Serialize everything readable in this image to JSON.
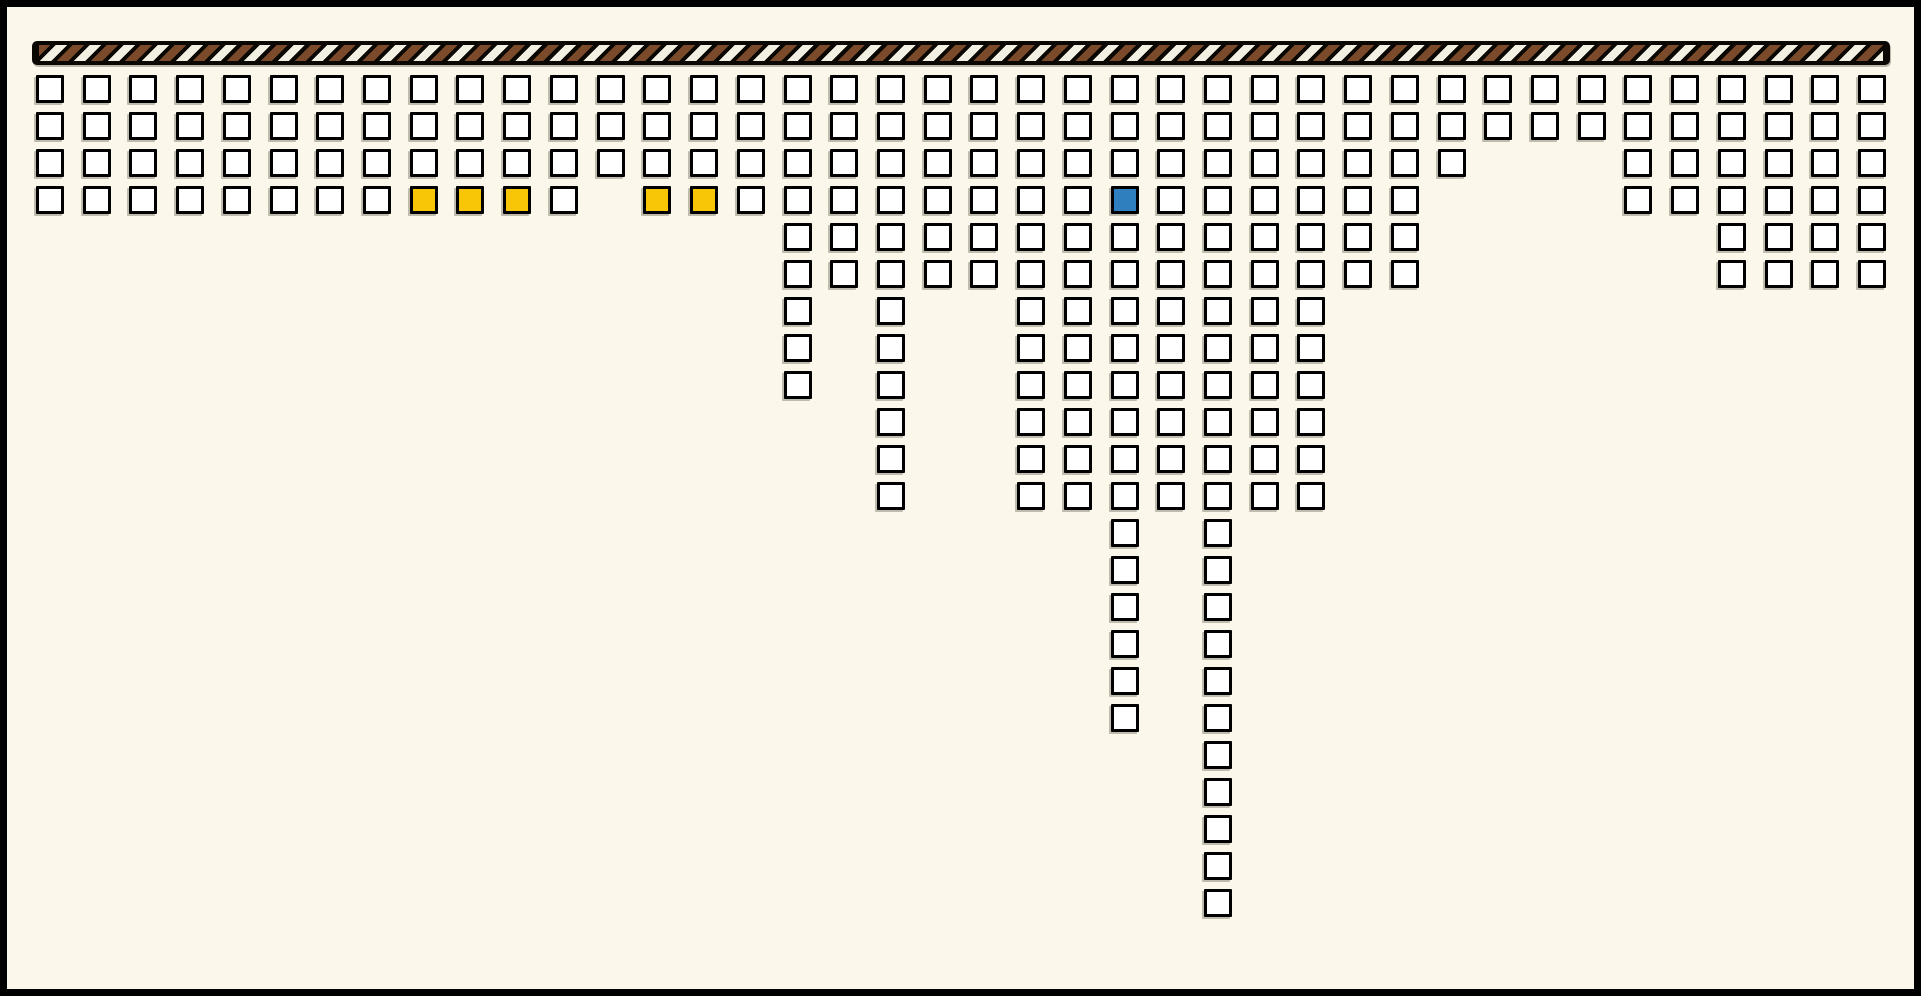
{
  "frame": {
    "background_color": "#FBF8EB",
    "border_color": "#000000"
  },
  "rope_bar": {
    "description": "horizontal hatched bar at top from which all unit columns hang",
    "base_color": "#0B0803",
    "stripe_brown": "#7A4A2B",
    "stripe_white": "#F2EFE3",
    "stripe_direction": "diagonal-forward-slash"
  },
  "chart_data": {
    "type": "unit_column_pictograph",
    "title": "",
    "xlabel": "",
    "ylabel": "",
    "legend": [],
    "orientation": "40 columns of outlined unit squares hang downward from a hatched horizontal bar",
    "columns": 40,
    "counts": [
      4,
      4,
      4,
      4,
      4,
      4,
      4,
      4,
      4,
      4,
      4,
      4,
      3,
      4,
      4,
      4,
      9,
      6,
      12,
      6,
      6,
      12,
      12,
      18,
      12,
      23,
      12,
      12,
      6,
      6,
      3,
      2,
      2,
      2,
      4,
      4,
      6,
      6,
      6,
      6
    ],
    "max_count": 23,
    "total_units": 256,
    "unit_colors": {
      "default": "#FFFFFF",
      "gold": "#F9C607",
      "blue": "#2F7EBE"
    },
    "highlighted_units": [
      {
        "column": 8,
        "row": 4,
        "color": "gold"
      },
      {
        "column": 9,
        "row": 4,
        "color": "gold"
      },
      {
        "column": 10,
        "row": 4,
        "color": "gold"
      },
      {
        "column": 13,
        "row": 4,
        "color": "gold"
      },
      {
        "column": 14,
        "row": 4,
        "color": "gold"
      },
      {
        "column": 23,
        "row": 4,
        "color": "blue"
      }
    ]
  }
}
